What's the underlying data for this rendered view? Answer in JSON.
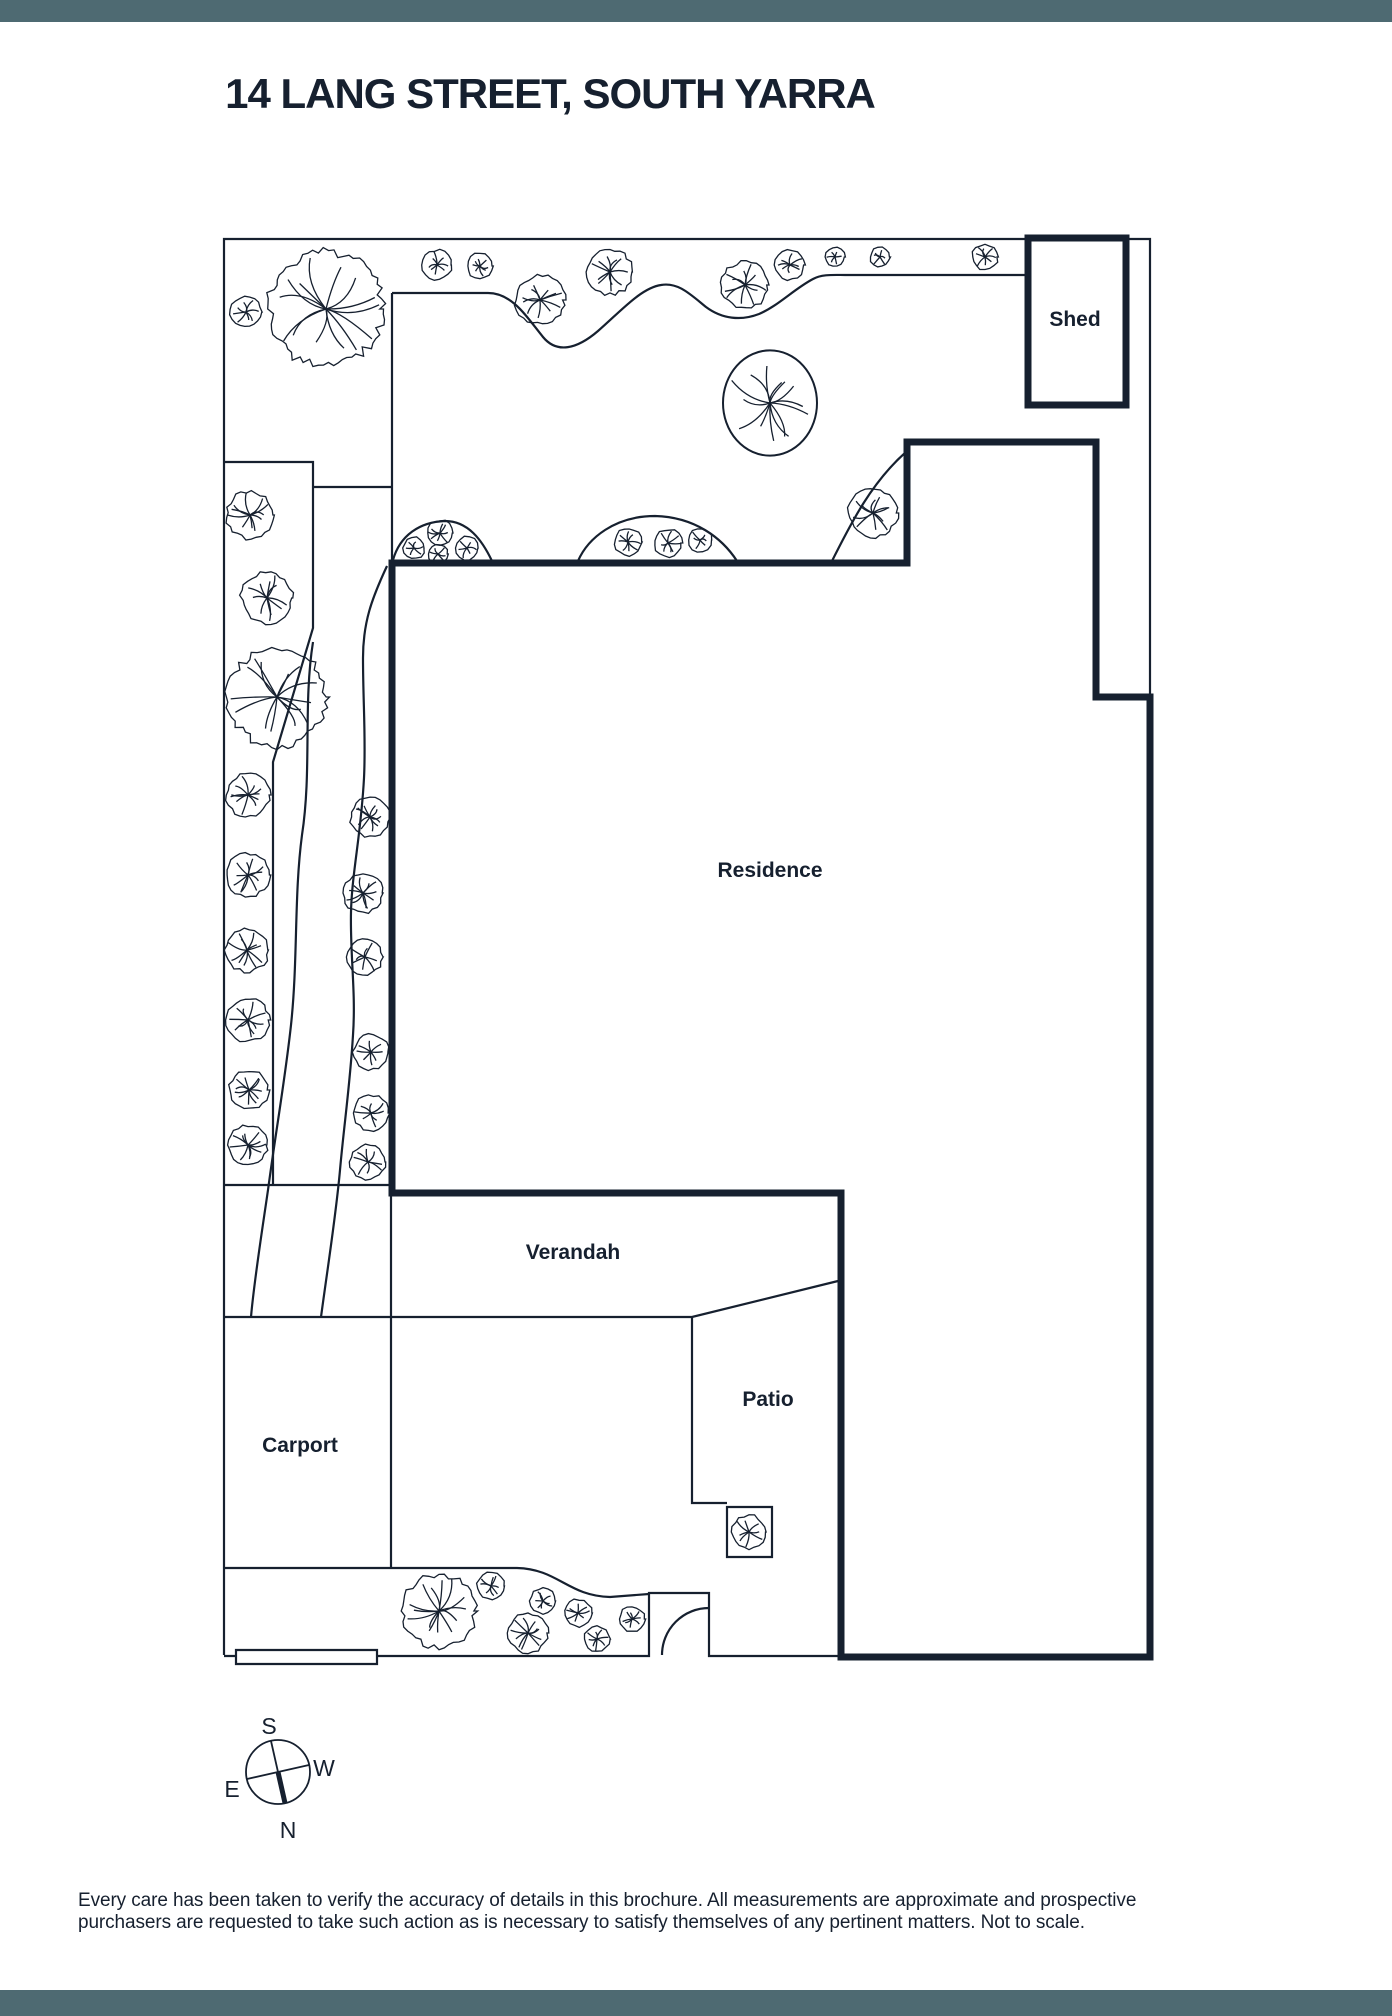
{
  "page": {
    "title": "14 LANG STREET, SOUTH YARRA",
    "disclaimer_line1": "Every care has been taken to verify the accuracy of details in this brochure. All measurements are approximate and prospective",
    "disclaimer_line2": "purchasers are requested to take such action as is necessary to satisfy themselves of any pertinent matters. Not to scale.",
    "accent_color": "#4e6a72",
    "ink_color": "#16202f"
  },
  "plan": {
    "labels": [
      {
        "id": "shed",
        "text": "Shed",
        "x": 1075,
        "y": 326
      },
      {
        "id": "residence",
        "text": "Residence",
        "x": 770,
        "y": 877
      },
      {
        "id": "verandah",
        "text": "Verandah",
        "x": 573,
        "y": 1259
      },
      {
        "id": "patio",
        "text": "Patio",
        "x": 768,
        "y": 1406
      },
      {
        "id": "carport",
        "text": "Carport",
        "x": 300,
        "y": 1452
      }
    ],
    "bold_outline_points": "392,563 907,563 907,442 1096,442 1096,697 1150,697 1150,1657 841,1657 841,1193 392,1193",
    "shed_rect": {
      "x": 1028,
      "y": 238,
      "w": 98,
      "h": 167
    },
    "thin_paths": [
      {
        "d": "M1150,697 V239 H224 V1655"
      },
      {
        "d": "M224,1656 H649 V1593 H709 V1656 H841"
      },
      {
        "d": "M662,1655 A47,47 0 0 1 709,1608"
      },
      {
        "d": "M236,1650 H377 V1664 H236 Z",
        "fill": "#ffffff"
      },
      {
        "d": "M225,462 H313 V628 L273,762 V1185"
      },
      {
        "d": "M313,487 H392"
      },
      {
        "d": "M225,1185 H392"
      },
      {
        "d": "M313,642 C303,705 312,770 302,835 C294,895 298,960 291,1025 C285,1080 276,1130 268,1190 C261,1238 254,1282 251,1317"
      },
      {
        "d": "M387,566 C372,598 363,622 363,658 C363,702 366,738 364,778 C361,835 352,872 351,912 C350,955 356,992 353,1035 C350,1085 344,1125 340,1170 C336,1215 328,1265 321,1317"
      },
      {
        "d": "M224,1317 H392"
      },
      {
        "d": "M391,1193 V1568"
      },
      {
        "d": "M224,1568 H391"
      },
      {
        "d": "M392,1317 H692 L838,1281"
      },
      {
        "d": "M692,1317 V1503 H727"
      },
      {
        "d": "M727,1507 H772 V1557 H727 Z",
        "fill": "#ffffff"
      },
      {
        "d": "M391,1568 H517 C558,1569 568,1596 610,1597 L649,1594"
      },
      {
        "d": "M392,293 H488 C512,293 526,316 543,337 C557,354 577,349 598,331 C621,311 641,288 661,285 C678,282 690,294 706,307 C722,319 741,321 759,314 C778,306 794,289 813,279 C822,274 834,275 845,275 H1028"
      },
      {
        "d": "M392,293 V563"
      },
      {
        "d": "M393,560 C400,535 420,522 445,521 C468,521 482,540 492,561"
      },
      {
        "d": "M578,561 C588,538 615,516 655,516 C695,517 722,538 737,561"
      },
      {
        "d": "M831,563 C852,521 872,482 906,452"
      }
    ],
    "trees": [
      {
        "x": 246,
        "y": 312,
        "r": 16
      },
      {
        "x": 326,
        "y": 309,
        "r": 58
      },
      {
        "x": 437,
        "y": 265,
        "r": 15
      },
      {
        "x": 480,
        "y": 266,
        "r": 13
      },
      {
        "x": 540,
        "y": 300,
        "r": 25
      },
      {
        "x": 610,
        "y": 272,
        "r": 23
      },
      {
        "x": 745,
        "y": 285,
        "r": 24
      },
      {
        "x": 790,
        "y": 265,
        "r": 15
      },
      {
        "x": 835,
        "y": 257,
        "r": 10
      },
      {
        "x": 880,
        "y": 257,
        "r": 10
      },
      {
        "x": 985,
        "y": 257,
        "r": 13
      },
      {
        "x": 770,
        "y": 403,
        "r": 47,
        "smooth": true
      },
      {
        "x": 873,
        "y": 513,
        "r": 25
      },
      {
        "x": 414,
        "y": 548,
        "r": 11
      },
      {
        "x": 440,
        "y": 533,
        "r": 13
      },
      {
        "x": 438,
        "y": 554,
        "r": 10
      },
      {
        "x": 467,
        "y": 548,
        "r": 12
      },
      {
        "x": 628,
        "y": 542,
        "r": 14
      },
      {
        "x": 668,
        "y": 543,
        "r": 14
      },
      {
        "x": 700,
        "y": 540,
        "r": 12
      },
      {
        "x": 250,
        "y": 515,
        "r": 24
      },
      {
        "x": 267,
        "y": 598,
        "r": 26
      },
      {
        "x": 277,
        "y": 697,
        "r": 50
      },
      {
        "x": 248,
        "y": 795,
        "r": 22
      },
      {
        "x": 248,
        "y": 875,
        "r": 22
      },
      {
        "x": 247,
        "y": 950,
        "r": 22
      },
      {
        "x": 248,
        "y": 1020,
        "r": 22
      },
      {
        "x": 249,
        "y": 1090,
        "r": 20
      },
      {
        "x": 248,
        "y": 1145,
        "r": 20
      },
      {
        "x": 370,
        "y": 817,
        "r": 20
      },
      {
        "x": 363,
        "y": 893,
        "r": 20
      },
      {
        "x": 365,
        "y": 957,
        "r": 18
      },
      {
        "x": 371,
        "y": 1052,
        "r": 18
      },
      {
        "x": 371,
        "y": 1113,
        "r": 18
      },
      {
        "x": 368,
        "y": 1162,
        "r": 18
      },
      {
        "x": 439,
        "y": 1611,
        "r": 37
      },
      {
        "x": 491,
        "y": 1586,
        "r": 14
      },
      {
        "x": 543,
        "y": 1601,
        "r": 13
      },
      {
        "x": 528,
        "y": 1633,
        "r": 20
      },
      {
        "x": 578,
        "y": 1613,
        "r": 14
      },
      {
        "x": 597,
        "y": 1639,
        "r": 13
      },
      {
        "x": 632,
        "y": 1619,
        "r": 13
      },
      {
        "x": 749,
        "y": 1532,
        "r": 17
      }
    ],
    "compass": {
      "cx": 278,
      "cy": 1772,
      "r": 32,
      "spokes": [
        {
          "label": "S",
          "x2": 271,
          "y2": 1741,
          "thick": false,
          "lx": 269,
          "ly": 1734
        },
        {
          "label": "W",
          "x2": 309,
          "y2": 1765,
          "thick": false,
          "lx": 324,
          "ly": 1776
        },
        {
          "label": "E",
          "x2": 247,
          "y2": 1779,
          "thick": false,
          "lx": 232,
          "ly": 1797
        },
        {
          "label": "N",
          "x2": 285,
          "y2": 1803,
          "thick": true,
          "lx": 288,
          "ly": 1838
        }
      ]
    }
  }
}
